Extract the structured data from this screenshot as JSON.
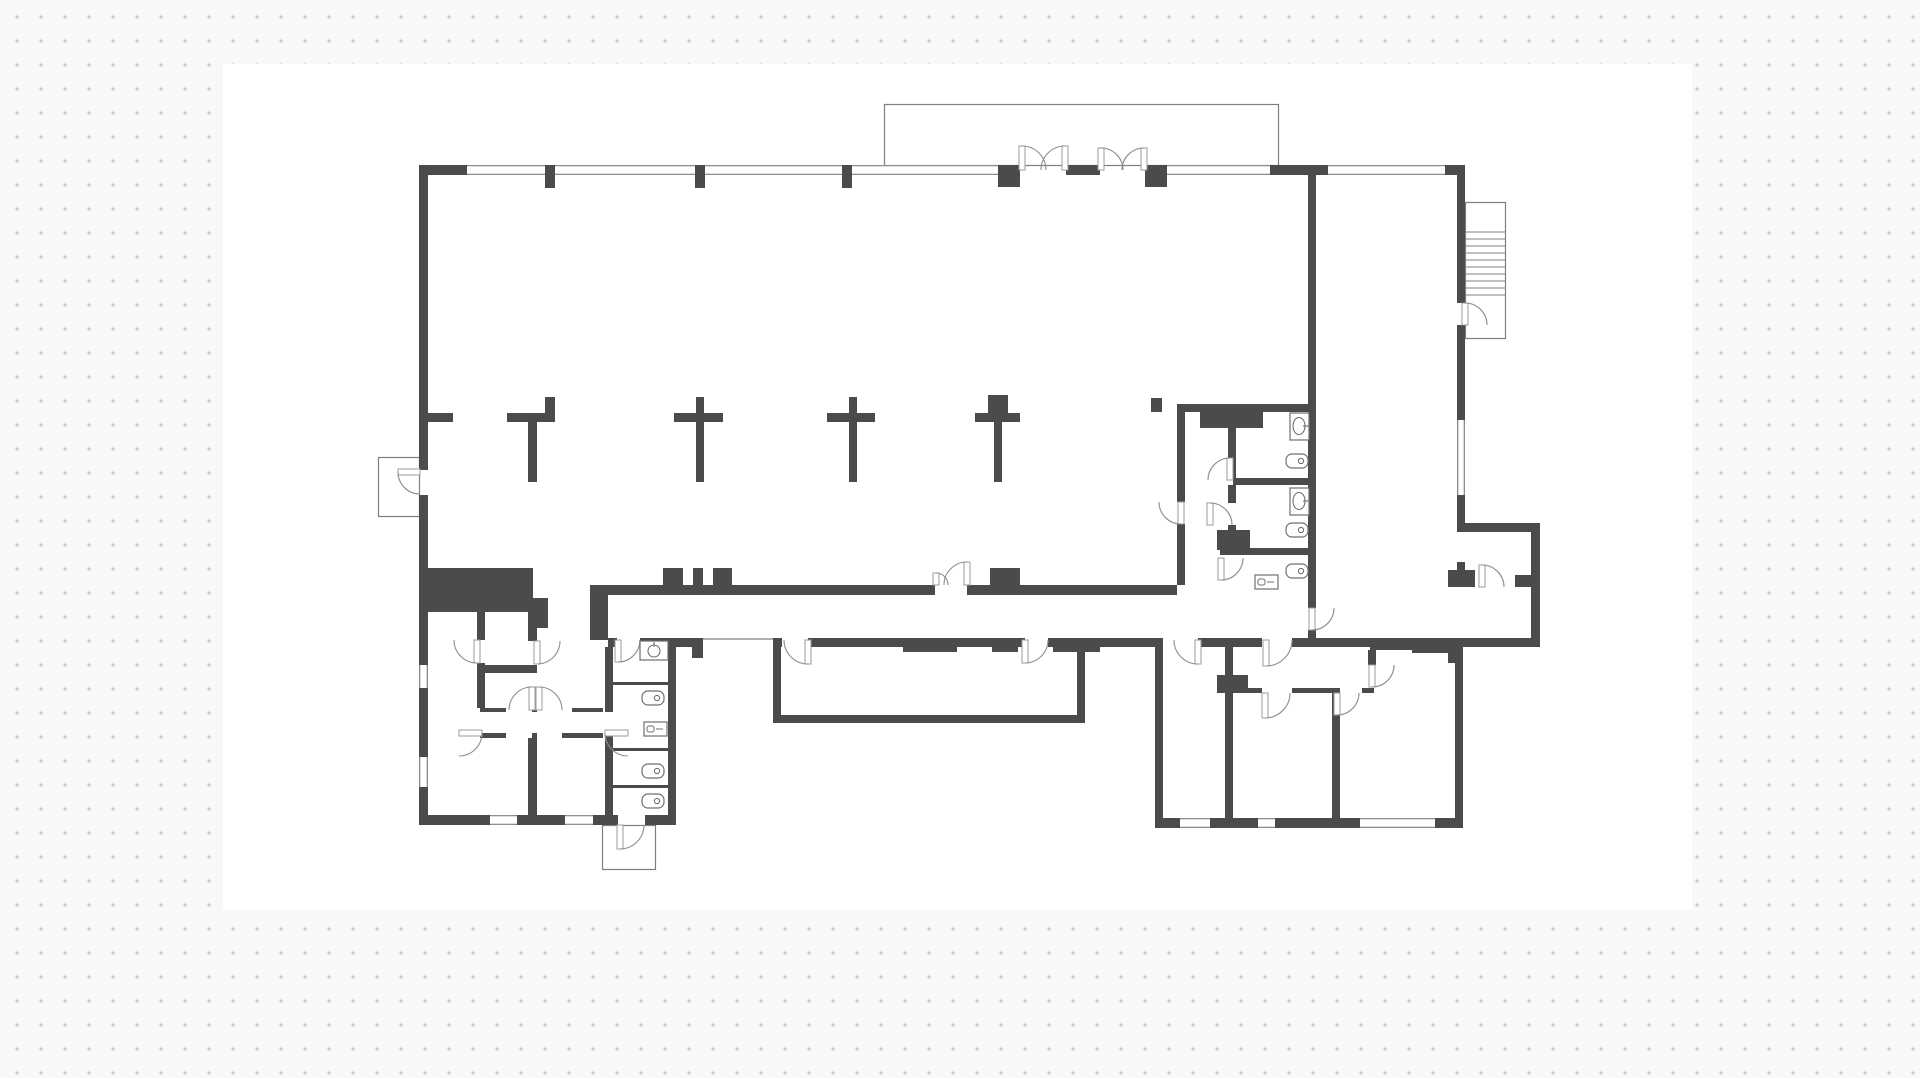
{
  "document": {
    "title": "floor-plan-drawing",
    "type": "architectural-first-floor-plan",
    "visible_text": []
  },
  "canvas": {
    "w": 1920,
    "h": 1078,
    "bg": "#f8f8f9",
    "dot_color": "#c9c9c9",
    "dot_size": 3,
    "dot_gap": 24
  },
  "sheet": {
    "x": 223,
    "y": 64,
    "w": 1469,
    "h": 846,
    "fill": "#ffffff"
  },
  "style": {
    "wall_color": "#4b4b4e",
    "thin_line": "#7f7f82",
    "arc_line": "#8d8d90",
    "leaf_stroke": "#9b9b9e",
    "fixture_line": "#6f6f72"
  },
  "plan": {
    "walls": [
      [
        419,
        165,
        48,
        10
      ],
      [
        545,
        165,
        10,
        23
      ],
      [
        695,
        165,
        10,
        23
      ],
      [
        842,
        165,
        10,
        23
      ],
      [
        998,
        165,
        22,
        22
      ],
      [
        1066,
        165,
        34,
        10
      ],
      [
        1145,
        165,
        22,
        22
      ],
      [
        1270,
        165,
        58,
        10
      ],
      [
        1445,
        165,
        20,
        10
      ],
      [
        419,
        165,
        9,
        305
      ],
      [
        419,
        495,
        9,
        170
      ],
      [
        419,
        688,
        9,
        69
      ],
      [
        419,
        787,
        9,
        38
      ],
      [
        419,
        815,
        71,
        10
      ],
      [
        517,
        815,
        48,
        10
      ],
      [
        593,
        815,
        25,
        10
      ],
      [
        645,
        815,
        31,
        10
      ],
      [
        1457,
        165,
        8,
        138
      ],
      [
        1457,
        325,
        8,
        95
      ],
      [
        1457,
        495,
        8,
        28
      ],
      [
        1308,
        175,
        8,
        229
      ],
      [
        1177,
        404,
        8,
        98
      ],
      [
        1177,
        524,
        8,
        61
      ],
      [
        1177,
        404,
        138,
        8
      ],
      [
        1308,
        404,
        8,
        191
      ],
      [
        1200,
        404,
        63,
        24
      ],
      [
        1228,
        412,
        8,
        66
      ],
      [
        1228,
        485,
        8,
        18
      ],
      [
        1228,
        525,
        8,
        23
      ],
      [
        1233,
        478,
        83,
        7
      ],
      [
        1220,
        548,
        96,
        7
      ],
      [
        1217,
        530,
        33,
        20
      ],
      [
        1308,
        595,
        8,
        13
      ],
      [
        1308,
        630,
        8,
        8
      ],
      [
        419,
        413,
        34,
        9
      ],
      [
        507,
        413,
        48,
        9
      ],
      [
        528,
        422,
        9,
        60
      ],
      [
        545,
        397,
        10,
        16
      ],
      [
        674,
        413,
        49,
        9
      ],
      [
        696,
        422,
        8,
        60
      ],
      [
        696,
        397,
        8,
        16
      ],
      [
        827,
        413,
        48,
        9
      ],
      [
        849,
        422,
        8,
        60
      ],
      [
        849,
        397,
        8,
        16
      ],
      [
        975,
        413,
        45,
        9
      ],
      [
        994,
        422,
        8,
        60
      ],
      [
        988,
        395,
        20,
        18
      ],
      [
        1151,
        398,
        11,
        14
      ],
      [
        428,
        568,
        105,
        44
      ],
      [
        533,
        598,
        15,
        30
      ],
      [
        590,
        585,
        18,
        55
      ],
      [
        608,
        585,
        327,
        10
      ],
      [
        967,
        585,
        210,
        10
      ],
      [
        663,
        568,
        20,
        17
      ],
      [
        693,
        568,
        10,
        17
      ],
      [
        713,
        568,
        19,
        17
      ],
      [
        990,
        568,
        30,
        17
      ],
      [
        608,
        638,
        9,
        9
      ],
      [
        640,
        638,
        52,
        9
      ],
      [
        692,
        638,
        11,
        20
      ],
      [
        773,
        638,
        9,
        9
      ],
      [
        808,
        638,
        95,
        9
      ],
      [
        903,
        638,
        54,
        14
      ],
      [
        957,
        638,
        35,
        9
      ],
      [
        992,
        638,
        26,
        14
      ],
      [
        1018,
        638,
        7,
        9
      ],
      [
        1048,
        638,
        5,
        9
      ],
      [
        1053,
        638,
        47,
        14
      ],
      [
        1100,
        638,
        63,
        9
      ],
      [
        1198,
        638,
        64,
        9
      ],
      [
        1292,
        638,
        78,
        9
      ],
      [
        1370,
        638,
        42,
        12
      ],
      [
        1412,
        638,
        36,
        10
      ],
      [
        1448,
        638,
        15,
        25
      ],
      [
        1463,
        638,
        77,
        9
      ],
      [
        773,
        647,
        8,
        76
      ],
      [
        773,
        715,
        312,
        8
      ],
      [
        1077,
        647,
        8,
        76
      ],
      [
        477,
        612,
        8,
        28
      ],
      [
        477,
        663,
        8,
        45
      ],
      [
        477,
        665,
        60,
        8
      ],
      [
        528,
        612,
        9,
        29
      ],
      [
        528,
        738,
        9,
        77
      ],
      [
        605,
        647,
        8,
        65
      ],
      [
        605,
        733,
        8,
        82
      ],
      [
        668,
        647,
        8,
        168
      ],
      [
        480,
        708,
        26,
        4
      ],
      [
        532,
        708,
        5,
        4
      ],
      [
        572,
        708,
        31,
        4
      ],
      [
        480,
        733,
        26,
        5
      ],
      [
        532,
        733,
        5,
        5
      ],
      [
        562,
        733,
        41,
        5
      ],
      [
        613,
        682,
        55,
        3
      ],
      [
        613,
        748,
        55,
        3
      ],
      [
        613,
        785,
        55,
        3
      ],
      [
        1155,
        640,
        8,
        178
      ],
      [
        1225,
        640,
        8,
        36
      ],
      [
        1217,
        675,
        31,
        18
      ],
      [
        1225,
        693,
        8,
        125
      ],
      [
        1248,
        688,
        14,
        5
      ],
      [
        1292,
        688,
        48,
        5
      ],
      [
        1362,
        688,
        12,
        5
      ],
      [
        1332,
        688,
        8,
        130
      ],
      [
        1368,
        650,
        8,
        15
      ],
      [
        1412,
        648,
        36,
        5
      ],
      [
        1455,
        663,
        8,
        155
      ],
      [
        1155,
        818,
        25,
        10
      ],
      [
        1210,
        818,
        48,
        10
      ],
      [
        1275,
        818,
        85,
        10
      ],
      [
        1435,
        818,
        28,
        10
      ],
      [
        1457,
        523,
        83,
        9
      ],
      [
        1531,
        523,
        9,
        122
      ],
      [
        1448,
        570,
        27,
        17
      ],
      [
        1457,
        562,
        8,
        8
      ],
      [
        1515,
        575,
        25,
        12
      ]
    ],
    "windows": [
      [
        467,
        165,
        78,
        10,
        "h"
      ],
      [
        555,
        165,
        140,
        10,
        "h"
      ],
      [
        705,
        165,
        137,
        10,
        "h"
      ],
      [
        852,
        165,
        146,
        10,
        "h"
      ],
      [
        1167,
        165,
        103,
        10,
        "h"
      ],
      [
        1328,
        165,
        117,
        10,
        "h"
      ],
      [
        419,
        665,
        9,
        23,
        "v"
      ],
      [
        419,
        757,
        9,
        30,
        "v"
      ],
      [
        1457,
        420,
        8,
        75,
        "v"
      ],
      [
        490,
        815,
        27,
        10,
        "h"
      ],
      [
        565,
        815,
        28,
        10,
        "h"
      ],
      [
        1180,
        818,
        30,
        10,
        "h"
      ],
      [
        1258,
        818,
        17,
        10,
        "h"
      ],
      [
        1360,
        818,
        75,
        10,
        "h"
      ]
    ],
    "openings": [
      [
        703,
        638,
        70
      ]
    ],
    "outlines": [
      {
        "name": "vestibule-bump-out",
        "r": [
          884,
          104,
          394,
          61
        ]
      },
      {
        "name": "left-entry-porch",
        "r": [
          378,
          457,
          41,
          59
        ]
      },
      {
        "name": "south-entry-porch",
        "r": [
          602,
          825,
          53,
          44
        ]
      },
      {
        "name": "exterior-stair",
        "r": [
          1465,
          202,
          40,
          136
        ]
      }
    ],
    "stairs": {
      "x1": 1465,
      "x2": 1505,
      "y0": 232,
      "dy": 7,
      "n": 10
    },
    "doors": [
      [
        1022,
        170,
        24,
        90,
        0
      ],
      [
        1065,
        170,
        24,
        90,
        180
      ],
      [
        1101,
        170,
        22,
        90,
        0
      ],
      [
        1144,
        170,
        22,
        90,
        180
      ],
      [
        936,
        585,
        12,
        90,
        0
      ],
      [
        967,
        585,
        23,
        90,
        180
      ],
      [
        420,
        472,
        22,
        180,
        270
      ],
      [
        1465,
        325,
        22,
        90,
        0
      ],
      [
        1181,
        502,
        22,
        270,
        180
      ],
      [
        1230,
        480,
        22,
        90,
        180
      ],
      [
        1210,
        525,
        22,
        90,
        0
      ],
      [
        1221,
        558,
        22,
        270,
        0
      ],
      [
        1312,
        608,
        22,
        270,
        0
      ],
      [
        1482,
        587,
        22,
        90,
        0
      ],
      [
        808,
        640,
        24,
        270,
        180
      ],
      [
        1025,
        640,
        23,
        270,
        0
      ],
      [
        1198,
        640,
        24,
        270,
        180
      ],
      [
        1266,
        640,
        26,
        270,
        0
      ],
      [
        1265,
        693,
        25,
        270,
        0
      ],
      [
        1337,
        693,
        22,
        270,
        0
      ],
      [
        1372,
        665,
        22,
        270,
        0
      ],
      [
        618,
        640,
        22,
        270,
        0
      ],
      [
        477,
        640,
        23,
        270,
        180
      ],
      [
        537,
        641,
        23,
        270,
        0
      ],
      [
        532,
        710,
        23,
        90,
        180
      ],
      [
        539,
        710,
        23,
        90,
        0
      ],
      [
        459,
        733,
        23,
        0,
        270
      ],
      [
        628,
        733,
        23,
        180,
        270
      ],
      [
        620,
        825,
        24,
        270,
        0
      ]
    ],
    "fixtures": {
      "toilets": [
        [
          1297,
          461
        ],
        [
          1297,
          530
        ],
        [
          1297,
          571
        ],
        [
          653,
          698
        ],
        [
          653,
          771
        ],
        [
          653,
          801
        ]
      ],
      "sinks": [
        [
          1290,
          413
        ],
        [
          1290,
          488
        ]
      ],
      "sink_round": [
        [
          640,
          641
        ]
      ],
      "urinals": [
        [
          1255,
          575
        ],
        [
          644,
          722
        ]
      ]
    }
  }
}
